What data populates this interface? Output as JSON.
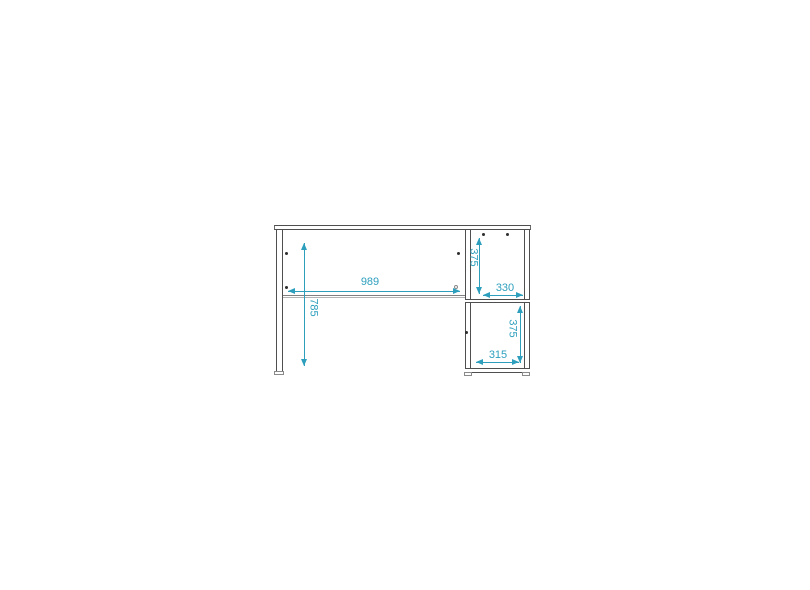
{
  "colors": {
    "dimension": "#2d9fbd",
    "line": "#4f4f4f"
  },
  "dimensions": {
    "desk_opening_width": "989",
    "desk_height": "785",
    "upper_compartment_height": "375",
    "upper_compartment_width": "330",
    "lower_compartment_height": "375",
    "lower_compartment_width": "315"
  }
}
